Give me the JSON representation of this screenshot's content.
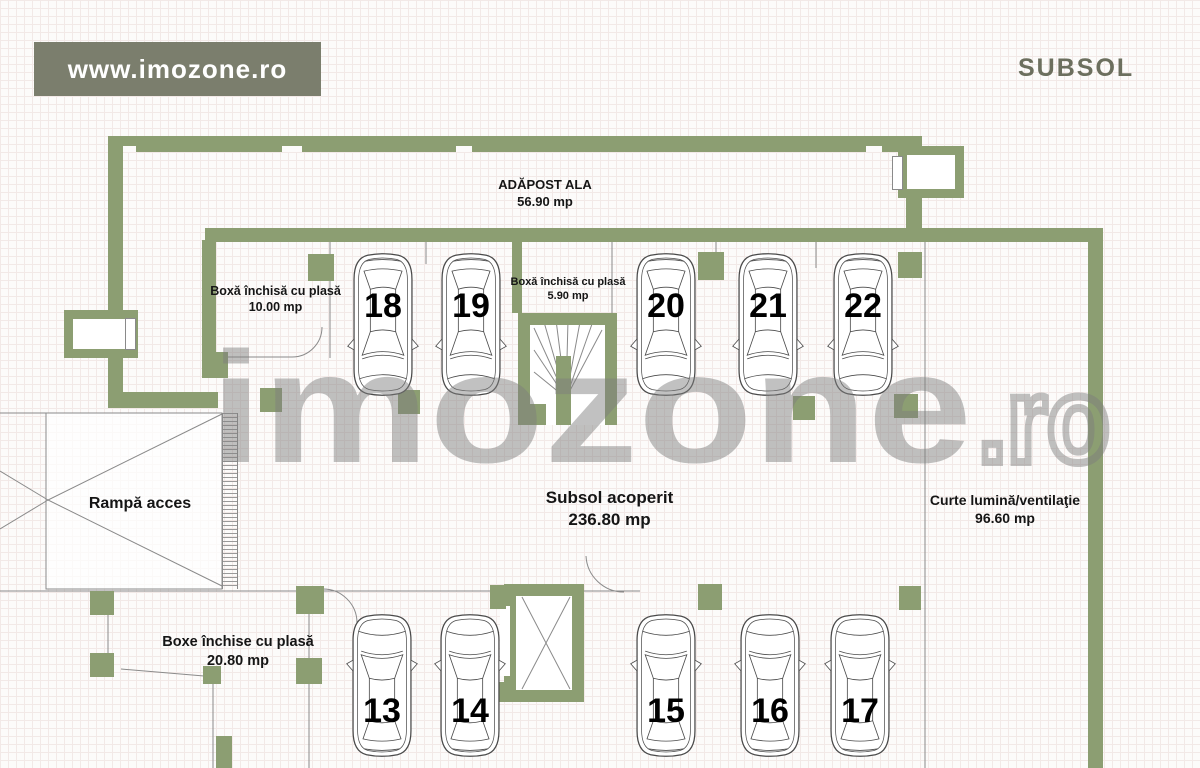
{
  "header": {
    "brand": "www.imozone.ro",
    "page_title": "SUBSOL"
  },
  "watermark": {
    "main": "imozone",
    "suffix": ".ro"
  },
  "colors": {
    "wall_green": "#8c9e72",
    "brand_bg": "#7b7e6d",
    "title_text": "#6c6f5e",
    "line_gray": "#8a8a8a",
    "label_text": "#151515"
  },
  "rooms": {
    "adapost": {
      "label": "ADĂPOST ALA",
      "area": "56.90 mp"
    },
    "boxa_10": {
      "label": "Boxă închisă cu plasă",
      "area": "10.00 mp"
    },
    "boxa_5_90": {
      "label": "Boxă închisă cu plasă",
      "area": "5.90 mp"
    },
    "subsol_acoperit": {
      "label": "Subsol acoperit",
      "area": "236.80 mp"
    },
    "rampa": {
      "label": "Rampă acces"
    },
    "curte": {
      "label": "Curte lumină/ventilaţie",
      "area": "96.60 mp"
    },
    "boxe": {
      "label": "Boxe închise cu plasă",
      "area": "20.80 mp"
    }
  },
  "parking": {
    "top_row": [
      "18",
      "19",
      "20",
      "21",
      "22"
    ],
    "bottom_row": [
      "13",
      "14",
      "15",
      "16",
      "17"
    ]
  }
}
